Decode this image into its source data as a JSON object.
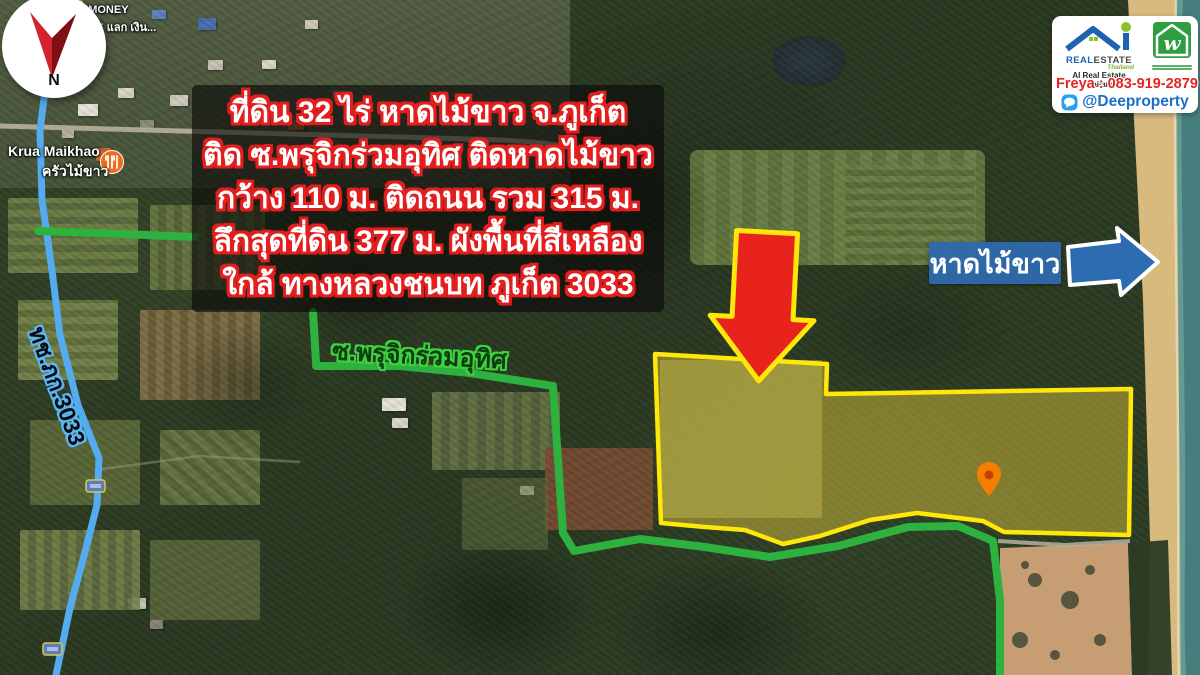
{
  "info_box": {
    "lines": [
      "ที่ดิน 32 ไร่ หาดไม้ขาว จ.ภูเก็ต",
      "ติด ซ.พรุจิกร่วมอุทิศ ติดหาดไม้ขาว",
      "กว้าง 110 ม. ติดถนน รวม 315 ม.",
      "ลึกสุดที่ดิน 377 ม. ผังพื้นที่สีเหลือง",
      "ใกล้ ทางหลวงชนบท ภูเก็ต 3033"
    ]
  },
  "map_labels": {
    "soi_road": "ซ.พรุจิกร่วมอุทิศ",
    "rural_road": "ทช.ภก.3033",
    "beach": "หาดไม้ขาว",
    "poi_restaurant_en": "Krua Maikhao",
    "poi_restaurant_th": "ครัวไม้ขาว",
    "money_exchange_line1": "P MONEY",
    "money_exchange_line2": "HANGE แลก เงิน..."
  },
  "compass": {
    "letter": "N"
  },
  "branding_card": {
    "brand_blue": "REAL",
    "brand_dark": "ESTATE",
    "brand_thailand": "Thailand",
    "brand_subtitle": "AI Real Estate Thailand",
    "w_letter": "w",
    "contact_phone": "Freya : 083-919-2879",
    "line_id": "@Deeproperty"
  },
  "colors": {
    "route_green": "#2db240",
    "route_blue": "#54abef",
    "plot_yellow": "#ffe70a",
    "plot_fill": "rgba(244,214,64,0.42)",
    "arrow_red": "#e7231c",
    "arrow_red_outline": "#ffe70a",
    "arrow_blue": "#2e6cb2",
    "beach_label_bg": "#2e69ae",
    "info_outline_red": "#e31e1e",
    "contact_red": "#e32421",
    "line_blue": "#1c6fc4",
    "sea": "#457e7c",
    "sand": "#d8b97e"
  }
}
